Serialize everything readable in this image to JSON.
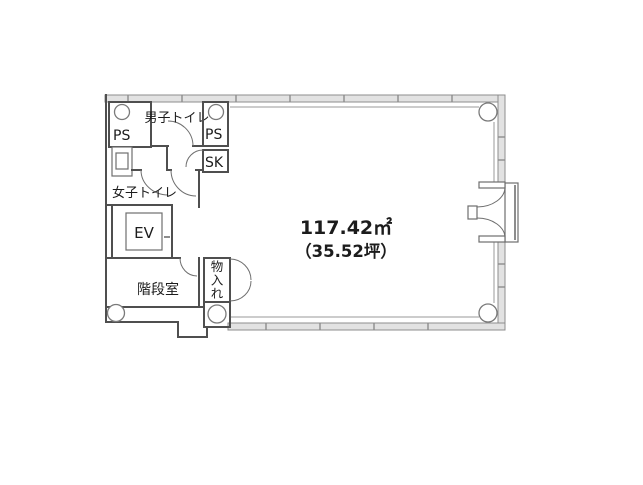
{
  "floor_plan": {
    "area_label": {
      "square_meters": "117.42㎡",
      "tsubo": "（35.52坪）"
    },
    "rooms": {
      "ps_left": "PS",
      "mens_toilet": "男子トイレ",
      "ps_right": "PS",
      "slop_sink": "SK",
      "womens_toilet": "女子トイレ",
      "elevator": "EV",
      "stairwell": "階段室",
      "storage": "物入れ"
    },
    "colors": {
      "wall": "#4f4f4f",
      "window_wall_fill": "#e2e2e2",
      "window_wall_stroke": "#8d8d8d",
      "fixture_line": "#6e6e6e",
      "text": "#1c1c1c"
    }
  }
}
